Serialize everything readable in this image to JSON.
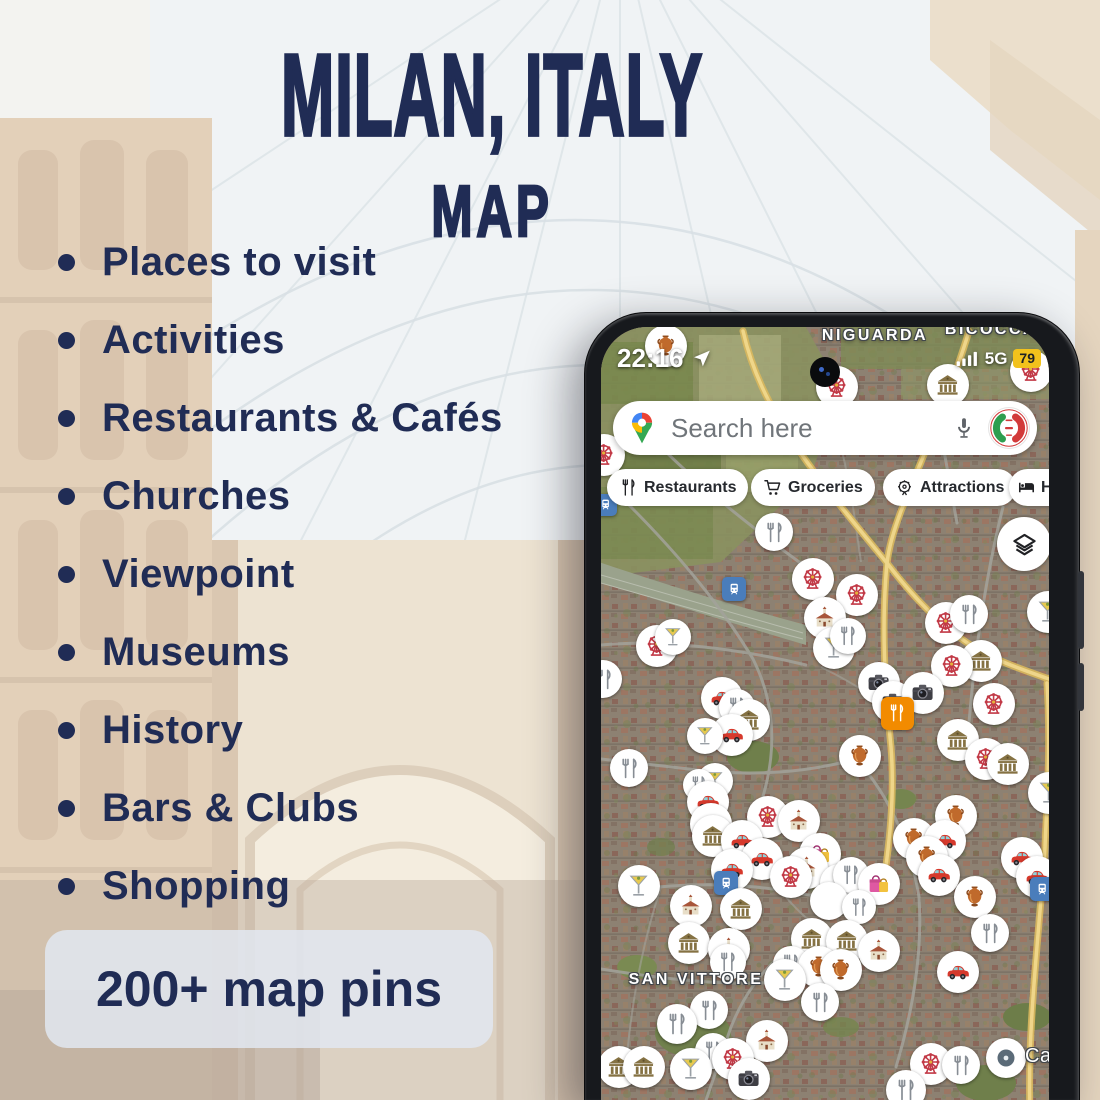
{
  "poster": {
    "title_line1": "MILAN, ITALY",
    "title_line2": "MAP",
    "features": [
      "Places to visit",
      "Activities",
      "Restaurants & Cafés",
      "Churches",
      "Viewpoint",
      "Museums",
      "History",
      "Bars & Clubs",
      "Shopping"
    ],
    "badge": "200+ map pins",
    "colors": {
      "navy": "#202c55",
      "badge_bg": "rgba(226,232,241,0.85)"
    }
  },
  "phone": {
    "status": {
      "time": "22:16",
      "network": "5G",
      "battery": "79",
      "battery_color": "#f2c21c"
    },
    "search": {
      "placeholder": "Search here"
    },
    "chips": [
      {
        "label": "Restaurants",
        "icon": "fork-knife-icon"
      },
      {
        "label": "Groceries",
        "icon": "cart-icon"
      },
      {
        "label": "Attractions",
        "icon": "ferris-wheel-icon"
      },
      {
        "label": "Hotels",
        "icon": "bed-icon"
      }
    ],
    "map": {
      "labels": [
        {
          "text": "NIGUARDA",
          "x": 274,
          "y": 0,
          "size": 16
        },
        {
          "text": "BICOCCA",
          "x": 390,
          "y": -6,
          "size": 16
        },
        {
          "text": "SAN VITTORE",
          "x": 95,
          "y": 644,
          "size": 16
        },
        {
          "text": "Casc",
          "x": 424,
          "y": 718,
          "size": 20,
          "plain": true
        }
      ],
      "pin_types": {
        "museum": "museum",
        "church": "church",
        "ferris": "attraction",
        "martini": "bar",
        "fork": "restaurant",
        "car": "car-rental",
        "camera": "viewpoint",
        "amphora": "history",
        "shopping": "shopping",
        "orangesq": "restaurant-poi",
        "transit": "train-station",
        "locdot": "saved-place",
        "blank": "cluster-pin"
      },
      "pins": [
        {
          "t": "amphora",
          "x": 65,
          "y": 19
        },
        {
          "t": "ferris",
          "x": 236,
          "y": 60
        },
        {
          "t": "museum",
          "x": 347,
          "y": 58
        },
        {
          "t": "ferris",
          "x": 430,
          "y": 44
        },
        {
          "t": "ferris",
          "x": 3,
          "y": 128
        },
        {
          "t": "transit",
          "x": 5,
          "y": 178,
          "s": 22
        },
        {
          "t": "fork",
          "x": 173,
          "y": 205,
          "s": 38
        },
        {
          "t": "transit",
          "x": 133,
          "y": 262,
          "s": 24
        },
        {
          "t": "ferris",
          "x": 212,
          "y": 252
        },
        {
          "t": "ferris",
          "x": 256,
          "y": 268
        },
        {
          "t": "church",
          "x": 224,
          "y": 291
        },
        {
          "t": "ferris",
          "x": 345,
          "y": 296
        },
        {
          "t": "fork",
          "x": 368,
          "y": 287,
          "s": 38
        },
        {
          "t": "martini",
          "x": 447,
          "y": 285
        },
        {
          "t": "ferris",
          "x": 56,
          "y": 319
        },
        {
          "t": "martini",
          "x": 72,
          "y": 310,
          "s": 36
        },
        {
          "t": "martini",
          "x": 233,
          "y": 321
        },
        {
          "t": "fork",
          "x": 247,
          "y": 309,
          "s": 36
        },
        {
          "t": "museum",
          "x": 380,
          "y": 334
        },
        {
          "t": "ferris",
          "x": 351,
          "y": 339
        },
        {
          "t": "fork",
          "x": 2,
          "y": 352,
          "s": 38
        },
        {
          "t": "camera",
          "x": 278,
          "y": 356
        },
        {
          "t": "camera",
          "x": 292,
          "y": 375
        },
        {
          "t": "camera",
          "x": 322,
          "y": 366
        },
        {
          "t": "car",
          "x": 121,
          "y": 371
        },
        {
          "t": "fork",
          "x": 136,
          "y": 380,
          "s": 36
        },
        {
          "t": "ferris",
          "x": 393,
          "y": 377
        },
        {
          "t": "orangesq",
          "x": 296,
          "y": 386,
          "s": 33
        },
        {
          "t": "museum",
          "x": 148,
          "y": 393
        },
        {
          "t": "car",
          "x": 131,
          "y": 408
        },
        {
          "t": "martini",
          "x": 104,
          "y": 409,
          "s": 36
        },
        {
          "t": "museum",
          "x": 357,
          "y": 413
        },
        {
          "t": "ferris",
          "x": 385,
          "y": 432
        },
        {
          "t": "museum",
          "x": 407,
          "y": 437
        },
        {
          "t": "amphora",
          "x": 259,
          "y": 429
        },
        {
          "t": "fork",
          "x": 28,
          "y": 441,
          "s": 38
        },
        {
          "t": "martini",
          "x": 114,
          "y": 454,
          "s": 36
        },
        {
          "t": "fork",
          "x": 98,
          "y": 458,
          "s": 32
        },
        {
          "t": "martini",
          "x": 448,
          "y": 466
        },
        {
          "t": "car",
          "x": 107,
          "y": 475
        },
        {
          "t": "amphora",
          "x": 355,
          "y": 489
        },
        {
          "t": "ferris",
          "x": 167,
          "y": 490
        },
        {
          "t": "church",
          "x": 198,
          "y": 494
        },
        {
          "t": "car",
          "x": 110,
          "y": 497
        },
        {
          "t": "museum",
          "x": 112,
          "y": 509
        },
        {
          "t": "car",
          "x": 141,
          "y": 514
        },
        {
          "t": "amphora",
          "x": 313,
          "y": 512
        },
        {
          "t": "car",
          "x": 344,
          "y": 514
        },
        {
          "t": "shopping",
          "x": 219,
          "y": 527
        },
        {
          "t": "amphora",
          "x": 326,
          "y": 530
        },
        {
          "t": "car",
          "x": 161,
          "y": 532
        },
        {
          "t": "car",
          "x": 421,
          "y": 531
        },
        {
          "t": "church",
          "x": 206,
          "y": 541
        },
        {
          "t": "car",
          "x": 131,
          "y": 543
        },
        {
          "t": "blank",
          "x": 238,
          "y": 556,
          "s": 38
        },
        {
          "t": "fork",
          "x": 250,
          "y": 548,
          "s": 36
        },
        {
          "t": "ferris",
          "x": 190,
          "y": 550
        },
        {
          "t": "car",
          "x": 338,
          "y": 548
        },
        {
          "t": "car",
          "x": 436,
          "y": 550
        },
        {
          "t": "shopping",
          "x": 278,
          "y": 557
        },
        {
          "t": "transit",
          "x": 125,
          "y": 556,
          "s": 24
        },
        {
          "t": "martini",
          "x": 38,
          "y": 559
        },
        {
          "t": "blank",
          "x": 228,
          "y": 574,
          "s": 38
        },
        {
          "t": "amphora",
          "x": 374,
          "y": 570
        },
        {
          "t": "fork",
          "x": 258,
          "y": 580,
          "s": 34
        },
        {
          "t": "church",
          "x": 90,
          "y": 579
        },
        {
          "t": "museum",
          "x": 140,
          "y": 582
        },
        {
          "t": "transit",
          "x": 441,
          "y": 562,
          "s": 24
        },
        {
          "t": "fork",
          "x": 389,
          "y": 606,
          "s": 38
        },
        {
          "t": "museum",
          "x": 211,
          "y": 612
        },
        {
          "t": "museum",
          "x": 246,
          "y": 614
        },
        {
          "t": "museum",
          "x": 88,
          "y": 616
        },
        {
          "t": "church",
          "x": 128,
          "y": 622
        },
        {
          "t": "church",
          "x": 278,
          "y": 624
        },
        {
          "t": "fork",
          "x": 127,
          "y": 635,
          "s": 36
        },
        {
          "t": "fork",
          "x": 190,
          "y": 637,
          "s": 36
        },
        {
          "t": "amphora",
          "x": 218,
          "y": 640
        },
        {
          "t": "amphora",
          "x": 240,
          "y": 643
        },
        {
          "t": "car",
          "x": 357,
          "y": 645
        },
        {
          "t": "martini",
          "x": 184,
          "y": 653
        },
        {
          "t": "fork",
          "x": 219,
          "y": 675,
          "s": 38
        },
        {
          "t": "fork",
          "x": 108,
          "y": 683,
          "s": 38
        },
        {
          "t": "fork",
          "x": 76,
          "y": 697,
          "s": 40
        },
        {
          "t": "church",
          "x": 166,
          "y": 714
        },
        {
          "t": "fork",
          "x": 112,
          "y": 724,
          "s": 36
        },
        {
          "t": "martini",
          "x": 90,
          "y": 742
        },
        {
          "t": "ferris",
          "x": 132,
          "y": 732
        },
        {
          "t": "museum",
          "x": 18,
          "y": 740
        },
        {
          "t": "museum",
          "x": 43,
          "y": 740
        },
        {
          "t": "ferris",
          "x": 330,
          "y": 737
        },
        {
          "t": "fork",
          "x": 360,
          "y": 738,
          "s": 38
        },
        {
          "t": "camera",
          "x": 148,
          "y": 752
        },
        {
          "t": "fork",
          "x": 305,
          "y": 763,
          "s": 40
        },
        {
          "t": "locdot",
          "x": 405,
          "y": 731,
          "s": 40
        }
      ]
    }
  }
}
